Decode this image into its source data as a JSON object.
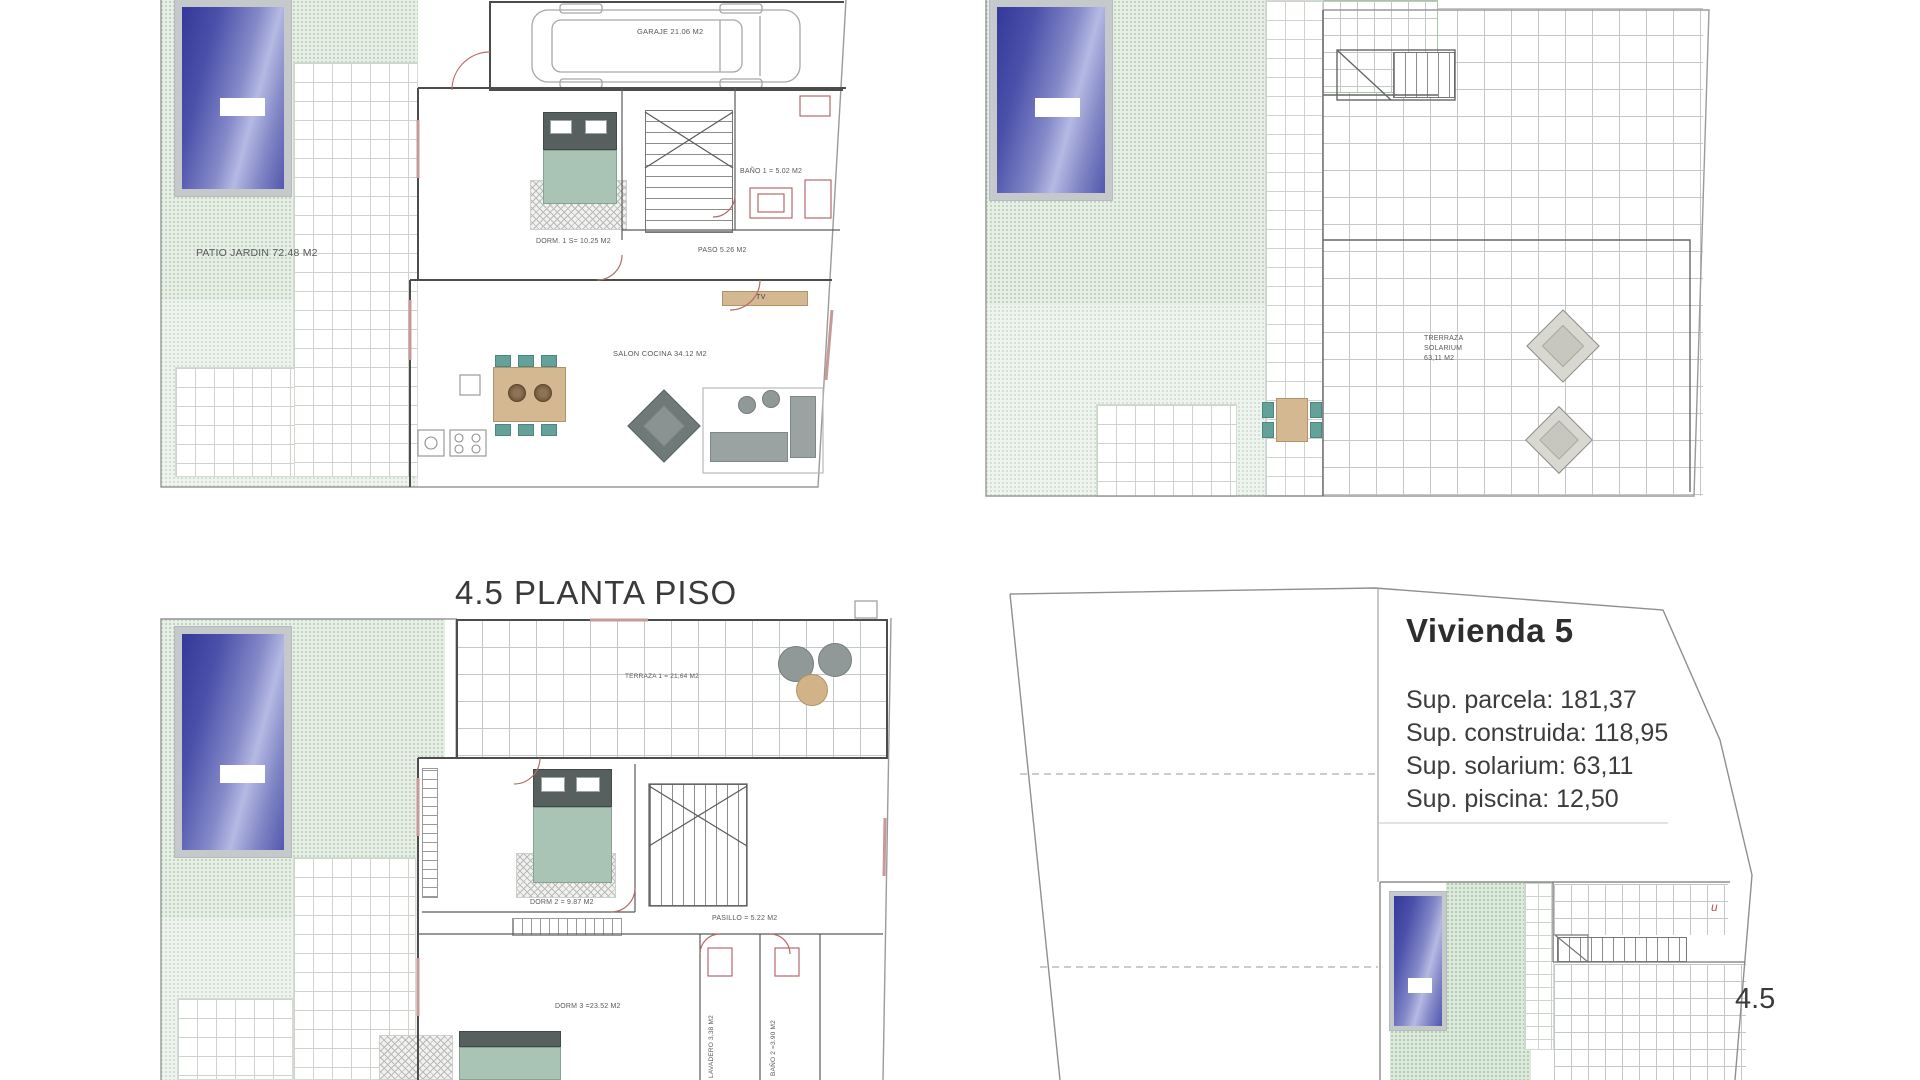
{
  "title": "4.5 PLANTA PISO",
  "ground_floor": {
    "patio_label": "PATIO JARDIN 72.48 M2",
    "garage_label": "GARAJE 21.06 M2",
    "dorm1_label": "DORM. 1 S= 10.25 M2",
    "bano1_label": "BAÑO 1 =  5.02 M2",
    "paso_label": "PASO 5.26 M2",
    "salon_label": "SALON COCINA 34.12 M2",
    "tv_label": "TV"
  },
  "solarium": {
    "label_line1": "TRERRAZA",
    "label_line2": "SOLARIUM",
    "label_line3": "63,11 M2"
  },
  "first_floor": {
    "terraza_label": "TERRAZA 1 = 21,64 M2",
    "dorm2_label": "DORM 2 = 9.87 M2",
    "pasillo_label": "PASILLO = 5.22 M2",
    "dorm3_label": "DORM 3 =23.52 M2",
    "lavadero_label": "LAVADERO 3,38 M2",
    "bano2_label": "BAÑO 2 =3.90 M2"
  },
  "plot": {
    "house_title": "Vivienda  5",
    "surface_lines": [
      "Sup. parcela: 181,37",
      "Sup. construida: 118,95",
      "Sup. solarium: 63,11",
      "Sup. piscina: 12,50"
    ],
    "plan_number": "4.5",
    "corner_mark": "u"
  },
  "colors": {
    "pool_dark": "#34399a",
    "pool_light": "#b5b9e3",
    "garden_green": "#e6eee6",
    "bed_green": "#a9c3b4",
    "wood_tan": "#d4b892",
    "chair_teal": "#63a19a",
    "wall_red": "#b46b6b",
    "text_dark": "#3a3a3a"
  }
}
